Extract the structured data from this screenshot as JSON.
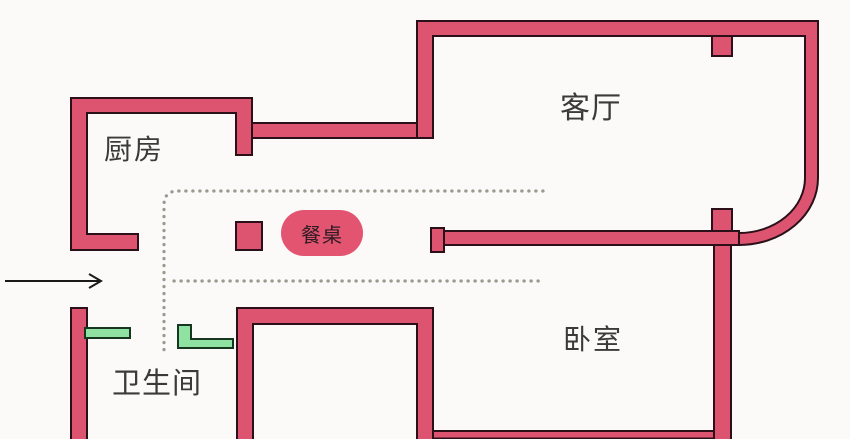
{
  "rooms": [
    {
      "id": "kitchen",
      "label": "厨房"
    },
    {
      "id": "living-room",
      "label": "客厅"
    },
    {
      "id": "bedroom",
      "label": "卧室"
    },
    {
      "id": "bathroom",
      "label": "卫生间"
    }
  ],
  "furniture": {
    "dining_table_label": "餐桌"
  },
  "icons": {
    "entry_arrow": "arrow-right"
  },
  "colors": {
    "background": "#fbfaf8",
    "wall-fill": "#dd5470",
    "wall-stroke": "#2b1019",
    "table-fill": "#e2546f",
    "door-fill": "#8fe2a2",
    "door-stroke": "#17361f",
    "dotted": "#9a9a8e",
    "label": "#3a3a3a",
    "table-label": "#2e1c24",
    "arrow": "#1a1a1a"
  }
}
